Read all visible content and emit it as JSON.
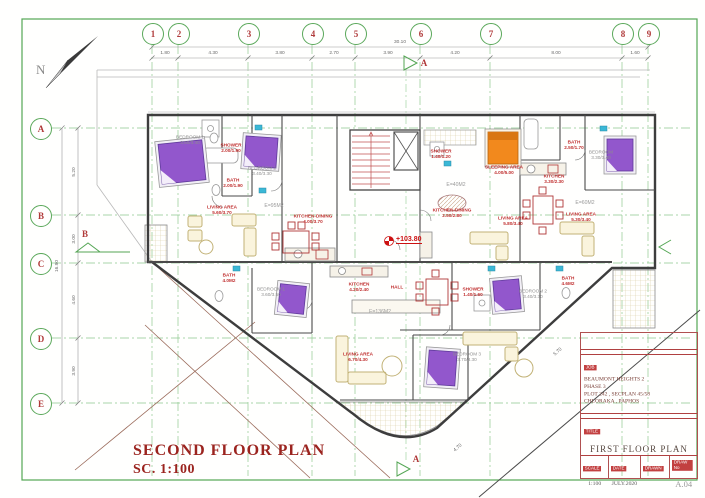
{
  "drawing": {
    "title": "SECOND FLOOR PLAN",
    "scale": "SC. 1:100",
    "north": "N",
    "level": "+103.80",
    "totals": {
      "width": "30.10",
      "height": "16.90"
    }
  },
  "grid": {
    "cols": [
      {
        "label": "1",
        "x": 152
      },
      {
        "label": "2",
        "x": 178
      },
      {
        "label": "3",
        "x": 248
      },
      {
        "label": "4",
        "x": 312
      },
      {
        "label": "5",
        "x": 355
      },
      {
        "label": "6",
        "x": 420
      },
      {
        "label": "7",
        "x": 490
      },
      {
        "label": "8",
        "x": 622
      },
      {
        "label": "9",
        "x": 648
      }
    ],
    "rows": [
      {
        "label": "A",
        "y": 128
      },
      {
        "label": "B",
        "y": 215
      },
      {
        "label": "C",
        "y": 263
      },
      {
        "label": "D",
        "y": 338
      },
      {
        "label": "E",
        "y": 403
      }
    ],
    "top_dims": [
      {
        "v": "1.80",
        "x": 165
      },
      {
        "v": "4.30",
        "x": 213
      },
      {
        "v": "3.80",
        "x": 280
      },
      {
        "v": "2.70",
        "x": 334
      },
      {
        "v": "3.90",
        "x": 388
      },
      {
        "v": "4.20",
        "x": 455
      },
      {
        "v": "8.00",
        "x": 556
      },
      {
        "v": "1.60",
        "x": 635
      }
    ],
    "left_dims": [
      {
        "v": "5.20",
        "y": 172
      },
      {
        "v": "3.00",
        "y": 239
      },
      {
        "v": "4.60",
        "y": 300
      },
      {
        "v": "3.90",
        "y": 371
      }
    ]
  },
  "sections": [
    {
      "label": "A",
      "x": 424,
      "y": 63
    },
    {
      "label": "B",
      "x": 85,
      "y": 234
    },
    {
      "label": "A",
      "x": 416,
      "y": 459
    }
  ],
  "rooms": [
    {
      "name": "SHOWER",
      "dims": "2.00/1.90",
      "x": 231,
      "y": 149
    },
    {
      "name": "BATH",
      "dims": "2.00/1.90",
      "x": 233,
      "y": 184
    },
    {
      "name": "BEDROOM 1",
      "dims": "3.50/3.40",
      "x": 190,
      "y": 141,
      "cls": "gray"
    },
    {
      "name": "BEDROOM 2",
      "dims": "3.40/3.30",
      "x": 262,
      "y": 172,
      "cls": "gray"
    },
    {
      "name": "LIVING AREA",
      "dims": "5.60/3.70",
      "x": 222,
      "y": 211
    },
    {
      "name": "KITCHEN-DINING",
      "dims": "4.00/3.70",
      "x": 313,
      "y": 220
    },
    {
      "name": "SHOWER",
      "dims": "1.40/1.20",
      "x": 441,
      "y": 155
    },
    {
      "name": "SLEEPING AREA",
      "dims": "4.00/5.00",
      "x": 504,
      "y": 171
    },
    {
      "name": "KITCHEN-DINING",
      "dims": "2.50/2.80",
      "x": 452,
      "y": 214
    },
    {
      "name": "LIVING AREA",
      "dims": "5.80/3.40",
      "x": 513,
      "y": 222
    },
    {
      "name": "BATH",
      "dims": "2.50/1.70",
      "x": 574,
      "y": 146
    },
    {
      "name": "KITCHEN",
      "dims": "3.30/2.30",
      "x": 554,
      "y": 180
    },
    {
      "name": "BEDROOM",
      "dims": "3.30/3.40",
      "x": 601,
      "y": 156,
      "cls": "gray"
    },
    {
      "name": "LIVING AREA",
      "dims": "5.30/3.40",
      "x": 581,
      "y": 218
    },
    {
      "name": "BATH",
      "dims": "4.0M2",
      "x": 229,
      "y": 279
    },
    {
      "name": "BEDROOM 1",
      "dims": "3.60/3.50",
      "x": 271,
      "y": 293,
      "cls": "gray"
    },
    {
      "name": "KITCHEN",
      "dims": "4.20/2.40",
      "x": 359,
      "y": 288
    },
    {
      "name": "HALL",
      "dims": "",
      "x": 397,
      "y": 288
    },
    {
      "name": "LIVING AREA",
      "dims": "6.70/4.30",
      "x": 358,
      "y": 358
    },
    {
      "name": "SHOWER",
      "dims": "1.40/1.60",
      "x": 473,
      "y": 293
    },
    {
      "name": "BEDROOM 2",
      "dims": "3.40/3.30",
      "x": 533,
      "y": 295,
      "cls": "gray"
    },
    {
      "name": "BATH",
      "dims": "4.6M2",
      "x": 568,
      "y": 282
    },
    {
      "name": "BEDROOM 3",
      "dims": "3.70/3.30",
      "x": 467,
      "y": 358,
      "cls": "gray"
    }
  ],
  "areas": [
    {
      "v": "E=95M2",
      "x": 274,
      "y": 206
    },
    {
      "v": "E=40M2",
      "x": 456,
      "y": 185
    },
    {
      "v": "E=60M2",
      "x": 585,
      "y": 203
    },
    {
      "v": "E=136M2",
      "x": 380,
      "y": 312
    }
  ],
  "diag_dims": [
    {
      "v": "4.70",
      "x": 458,
      "y": 448
    },
    {
      "v": "5.70",
      "x": 558,
      "y": 352
    }
  ],
  "title_block": {
    "project_label": "JOB",
    "project_lines": [
      "BEAUMONT HEIGHTS 2",
      "PHASE 3",
      "PLOT 242 , SECPLAN 45/58",
      "CHLORAKA , PAPHOS"
    ],
    "title_label": "TITLE",
    "drawing_title": "FIRST FLOOR PLAN",
    "cells": [
      {
        "label": "SCALE",
        "value": "1:100"
      },
      {
        "label": "DATE",
        "value": "JULY.2020"
      },
      {
        "label": "DRAWN",
        "value": ""
      },
      {
        "label": "DRAW No",
        "value": "A.04"
      }
    ]
  }
}
